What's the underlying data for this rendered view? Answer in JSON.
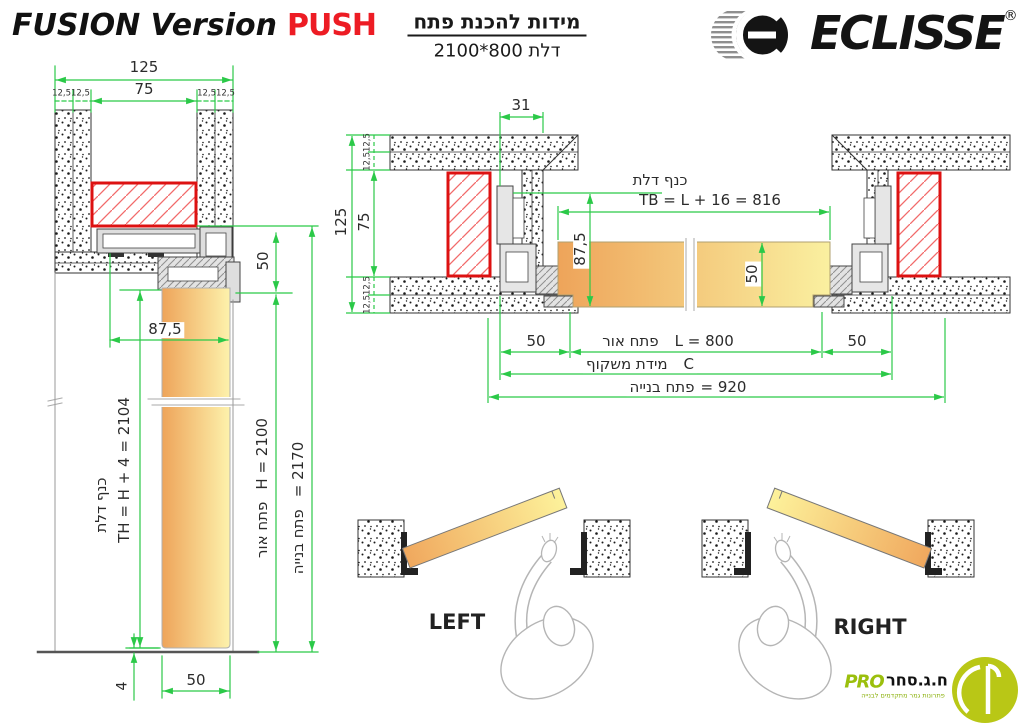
{
  "header": {
    "title": "FUSION Version",
    "title_highlight": "PUSH",
    "heading_he": "מידות להכנת פתח",
    "subheading_he": "דלת 800*2100",
    "brand": "ECLISSE",
    "brand_reg": "®"
  },
  "vertical_section": {
    "dim_total_width": "125",
    "dim_inner_width": "75",
    "dim_finish_left": "12,512,5",
    "dim_finish_right": "12,512,5",
    "dim_track_height": "50",
    "dim_overlap": "87,5",
    "leaf_label_he": "כנף דלת",
    "leaf_height_formula": "TH = H + 4 = 2104",
    "clear_height_label_he": "פתח אור",
    "clear_height_value": "H = 2100",
    "build_height_label_he": "פתח בנייה",
    "build_height_value": "= 2170",
    "dim_floor_gap": "4",
    "dim_leaf_thickness": "50"
  },
  "plan_section": {
    "dim_jamb": "31",
    "dim_total_wall": "125",
    "dim_core": "75",
    "dim_finish_top": "12,512,5",
    "dim_finish_bottom": "12,512,5",
    "leaf_label_he": "כנף דלת",
    "leaf_width_formula": "TB = L + 16 = 816",
    "dim_overlap": "87,5",
    "dim_leaf_thickness": "50",
    "dim_side_left": "50",
    "clear_width_label_he": "פתח אור",
    "clear_width_value": "L = 800",
    "dim_side_right": "50",
    "frame_label_he": "מידת משקוף",
    "frame_value": "C",
    "build_width_label_he": "פתח בנייה",
    "build_width_value": "= 920"
  },
  "swing_diagrams": {
    "left_label": "LEFT",
    "right_label": "RIGHT"
  },
  "footer_logo": {
    "pro": "PRO",
    "company_he": "ח.ג.סחר",
    "tagline_he": "פתרונות גמר מתקדמים לבנייה"
  },
  "colors": {
    "dimension_green": "#2bc948",
    "hatch_red": "#dd1111",
    "leaf_orange": "#eea45a",
    "leaf_yellow": "#fdf2ac",
    "push_red": "#ed1c24",
    "pro_green": "#b9c716"
  }
}
